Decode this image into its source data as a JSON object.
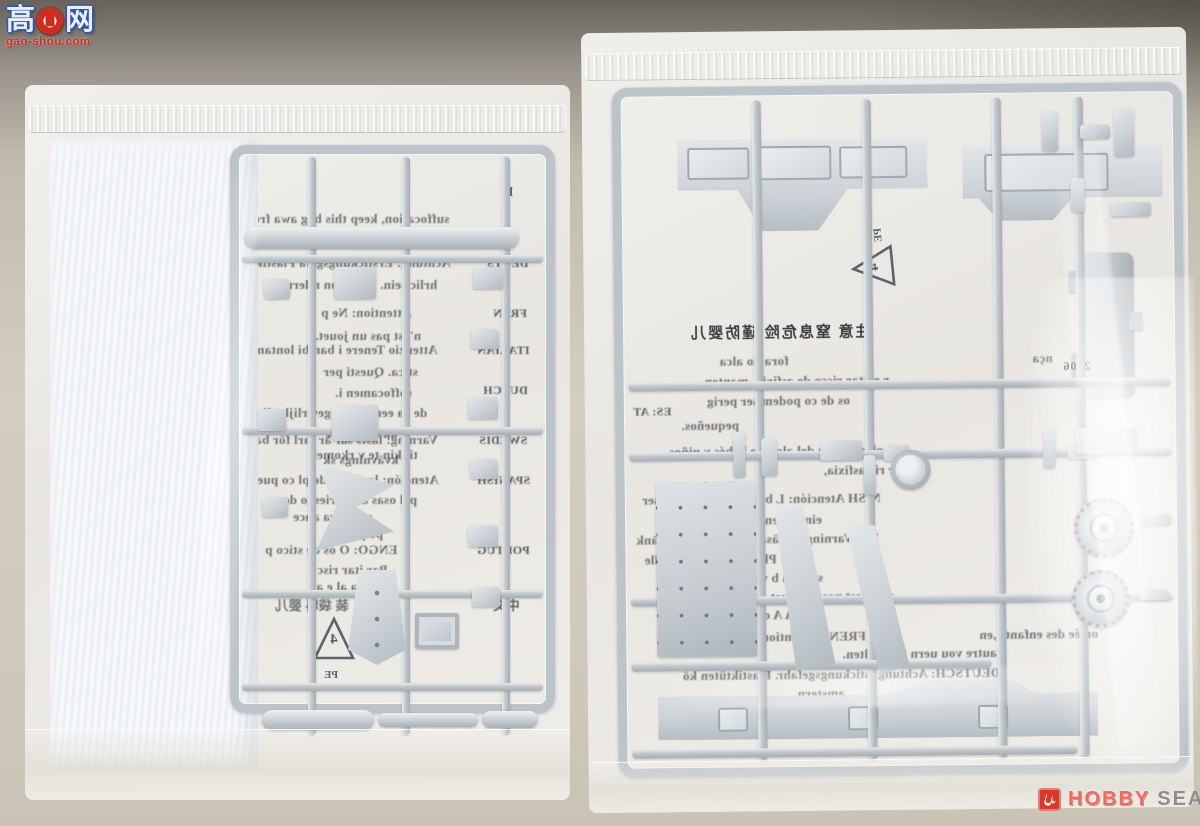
{
  "watermarks": {
    "gaoshou": {
      "char_left": "高",
      "char_right": "网",
      "site": "gao-shou.com"
    },
    "hobby_search": {
      "word_hobby": "HOBBY",
      "word_search": "SEARCH"
    }
  },
  "left_bag": {
    "sprue_letter": "E",
    "recycle_number": "4",
    "recycle_material": "PE",
    "sheet_lines": [
      {
        "text": "suffocation, keep this bag awa  fro",
        "x": 228,
        "y": 126,
        "size": 13
      },
      {
        "text": "children",
        "x": 352,
        "y": 147,
        "size": 13
      },
      {
        "text": "DEUTS",
        "x": 462,
        "y": 171,
        "size": 12,
        "label": true
      },
      {
        "text": "Achtung: Erstickungsgefa   Plastik",
        "x": 230,
        "y": 170,
        "size": 13
      },
      {
        "text": "hrlic  sein. Bitte von   ndern f",
        "x": 252,
        "y": 192,
        "size": 13
      },
      {
        "text": "FREN",
        "x": 468,
        "y": 221,
        "size": 12,
        "label": true
      },
      {
        "text": "Attention: Ne p",
        "x": 296,
        "y": 220,
        "size": 13
      },
      {
        "text": "n'est pas un jouet.",
        "x": 290,
        "y": 243,
        "size": 13
      },
      {
        "text": "ITALIAN",
        "x": 452,
        "y": 258,
        "size": 12,
        "label": true
      },
      {
        "text": "Attenzio   Tenere i bambi   lontan",
        "x": 232,
        "y": 257,
        "size": 13
      },
      {
        "text": "stica. Questi    per",
        "x": 298,
        "y": 279,
        "size": 13
      },
      {
        "text": "soffocamen i.",
        "x": 310,
        "y": 300,
        "size": 13
      },
      {
        "text": "DUTCH",
        "x": 458,
        "y": 298,
        "size": 12,
        "label": true
      },
      {
        "text": "de za   een  unnen gev  rlijk , li",
        "x": 238,
        "y": 320,
        "size": 13
      },
      {
        "text": "ak buiten   he",
        "x": 300,
        "y": 341,
        "size": 13
      },
      {
        "text": "tikkin   te v rkomei",
        "x": 288,
        "y": 362,
        "size": 13
      },
      {
        "text": "SWEDIS",
        "x": 454,
        "y": 348,
        "size": 12,
        "label": true
      },
      {
        "text": "Varning:  lasts sar är farl    för ba",
        "x": 230,
        "y": 347,
        "size": 13
      },
      {
        "text": "kvävnings sk",
        "x": 298,
        "y": 367,
        "size": 13
      },
      {
        "text": "SPANISH",
        "x": 452,
        "y": 388,
        "size": 12,
        "label": true
      },
      {
        "text": "Atención:  las b sas de pl co pue",
        "x": 232,
        "y": 387,
        "size": 13
      },
      {
        "text": "pel  osas  ara  r riesgo de a",
        "x": 248,
        "y": 407,
        "size": 13
      },
      {
        "text": "o ela   era   ance",
        "x": 268,
        "y": 424,
        "size": 13
      },
      {
        "text": "pequeños,",
        "x": 300,
        "y": 441,
        "size": 13
      },
      {
        "text": "PORTUG",
        "x": 452,
        "y": 458,
        "size": 12,
        "label": true
      },
      {
        "text": "ENGO: O    os de  stico  p",
        "x": 240,
        "y": 457,
        "size": 13
      },
      {
        "text": "Par   itar  risc",
        "x": 292,
        "y": 477,
        "size": 13
      },
      {
        "text": "fora   al    e as",
        "x": 286,
        "y": 494,
        "size": 13
      },
      {
        "text": "中文",
        "x": 468,
        "y": 510,
        "size": 13,
        "label": true
      },
      {
        "text": "装 袋料  婴儿",
        "x": 250,
        "y": 510,
        "size": 13
      }
    ]
  },
  "right_bag": {
    "recycle_number": "4",
    "recycle_material": "PE",
    "molded_number": "2906",
    "sheet_lines": [
      {
        "text": "注意 窒息危险 谨防婴儿",
        "x": 105,
        "y": 290,
        "size": 15,
        "dark": true
      },
      {
        "text": "fora do alca",
        "x": 135,
        "y": 322,
        "size": 13
      },
      {
        "text": "nça",
        "x": 448,
        "y": 322,
        "size": 13
      },
      {
        "text": "r  evitar  risco de asfixia, manten",
        "x": 120,
        "y": 342,
        "size": 13
      },
      {
        "text": "os de    co podem ser perig",
        "x": 122,
        "y": 362,
        "size": 13
      },
      {
        "text": "ES: AT",
        "x": 48,
        "y": 372,
        "size": 12,
        "label": true
      },
      {
        "text": "pequeños.",
        "x": 96,
        "y": 386,
        "size": 13
      },
      {
        "text": "colóquela fu    del alcance    bebés y niños.",
        "x": 80,
        "y": 412,
        "size": 13
      },
      {
        "text": "atar ric     asfixia,",
        "x": 238,
        "y": 432,
        "size": 13
      },
      {
        "text": "NISH   Atención: L   bolsas de p     pueden ser",
        "x": 56,
        "y": 460,
        "size": 13
      },
      {
        "text": "eingstr  en.",
        "x": 175,
        "y": 481,
        "size": 13
      },
      {
        "text": "DIS    Varning: F   päsar ar far    för b   n. Tänk",
        "x": 50,
        "y": 500,
        "size": 13
      },
      {
        "text": "CH    : Plas    ik   en kl  deren  alle",
        "x": 58,
        "y": 520,
        "size": 13
      },
      {
        "text": "soi   nen    b    vas",
        "x": 162,
        "y": 539,
        "size": 13
      },
      {
        "text": "sac n'est pas un jouet.",
        "x": 180,
        "y": 558,
        "size": 13
      },
      {
        "text": "IA     A    one g      mb",
        "x": 130,
        "y": 576,
        "size": 13
      },
      {
        "text": "FRENC    Attention:     pas laisser a",
        "x": 95,
        "y": 598,
        "size": 13
      },
      {
        "text": "ortée des enfants ,en",
        "x": 392,
        "y": 598,
        "size": 13
      },
      {
        "text": "autre vou     uern fernhalten.",
        "x": 255,
        "y": 616,
        "size": 13
      },
      {
        "text": "DEUTSCH: Achtung:    stickungsgefahr. Plastiktüten kö",
        "x": 95,
        "y": 636,
        "size": 13
      },
      {
        "text": "amstern.",
        "x": 206,
        "y": 655,
        "size": 13
      },
      {
        "text": "away from bab",
        "x": 330,
        "y": 672,
        "size": 13
      }
    ]
  },
  "colors": {
    "sprue_grey": "#c6ccd0",
    "bag_white": "#efeeea",
    "logo_red": "#cf2d22",
    "hobby_red": "#ee6a5e",
    "search_grey": "#8d8d89",
    "foam_white": "#f5f7f9"
  }
}
